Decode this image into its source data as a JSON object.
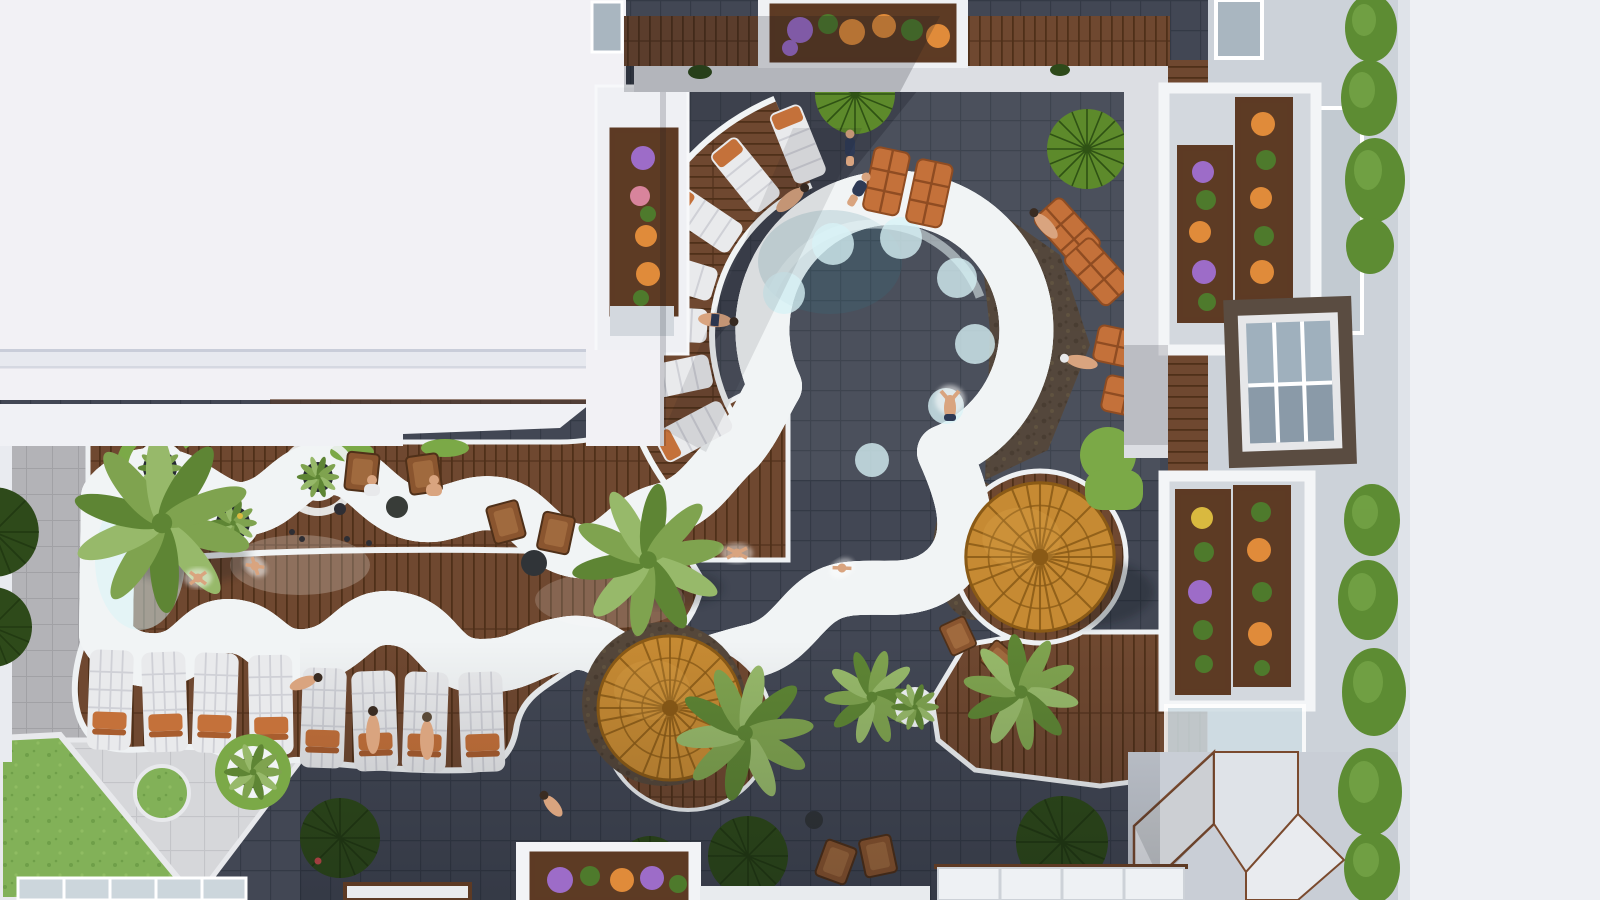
{
  "meta": {
    "type": "aerial-architectural-render",
    "description": "Top-down aerial 3D rendering of a resort apartment courtyard: a freeform turquoise lagoon pool connected to a circular plunge pool, surrounded by charcoal tile paving, timber decks, white sun loungers with orange towels, two round timber parasols, palm trees, lawn, and apartment balconies with flower planters.",
    "lighting": "midday sun with hard diagonal building shadows"
  },
  "scene": {
    "colors": {
      "roof_white": "#f2f1f5",
      "roof_band": "#e7e9ef",
      "wall_white": "#eef0f4",
      "facade_gray": "#ccd2d9",
      "window_glass": "#a9b6c0",
      "window_glass_pale": "#c2cad1",
      "window_frame_dark": "#5a4c41",
      "tile_dark": "#424754",
      "tile_grout": "#343a46",
      "tile_light": "#b3b3b7",
      "tile_light_grout": "#a1a1a5",
      "paver_light": "#d6d7da",
      "path_white": "#dcdee3",
      "coping_white": "#f1f4f5",
      "stone_band": "#55473a",
      "stone_dot": "#493c30",
      "wood": "#6f4830",
      "wood_dark": "#4f3019",
      "wood_deep": "#5d3a24",
      "water_light": "#b7e8f1",
      "water_mid": "#7fd2e4",
      "water_deep": "#55bfd6",
      "water_pale": "#d8f3f7",
      "lawn": "#82b158",
      "lawn_dark": "#6f9f49",
      "grass": "#7ba947",
      "canopy_green": "#5d8a2b",
      "canopy_dark": "#2f5214",
      "bush_dark": "#2e4a1a",
      "bush_streak": "#223a12",
      "hedge": "#5d8c33",
      "hedge_light": "#79a84a",
      "palm": "#7fa34f",
      "palm_light": "#97b96a",
      "palm_dark": "#5e8534",
      "umbrella": "#c68a33",
      "umbrella_dark": "#8a5a16",
      "lounger_white": "#e9eaec",
      "lounger_seam": "#cfd0d6",
      "towel_orange": "#c4713a",
      "chair_wood": "#8a552f",
      "flower_orange": "#e08b3a",
      "flower_purple": "#9d6cc8",
      "flower_pink": "#d8849c",
      "flower_yellow": "#d9b93f",
      "leaf_green": "#4e7a2c",
      "skin": "#d9a47f",
      "navy": "#2e3a55",
      "shadow": "#10151f",
      "pebble_dark": "#262a32",
      "glass_skylight": "#ccd6dc"
    },
    "areas": [
      "white-roof-top-left",
      "central-courtyard-dark-tile",
      "circular-plunge-pool",
      "freeform-lagoon-pool",
      "radial-timber-sun-deck",
      "lounger-timber-deck",
      "light-tile-plaza",
      "lawn-corner",
      "apartment-facade-right",
      "hedge-row",
      "white-roof-right",
      "skylight-roofs-bottom",
      "walkway-paths"
    ],
    "inventory": {
      "pools": 2,
      "timber_parasols": 2,
      "green_parasol_canopies": 2,
      "white_sun_loungers": 8,
      "poolside_loungers": 6,
      "radial_deck_daybeds": 7,
      "palm_trees": 5,
      "small_planter_palms": 5,
      "flower_planter_boxes": 8,
      "round_ring_planters": 4,
      "dark_topiary_circles": 7,
      "hedge_blobs": 9,
      "seating_groups": 3,
      "people": 17
    }
  }
}
